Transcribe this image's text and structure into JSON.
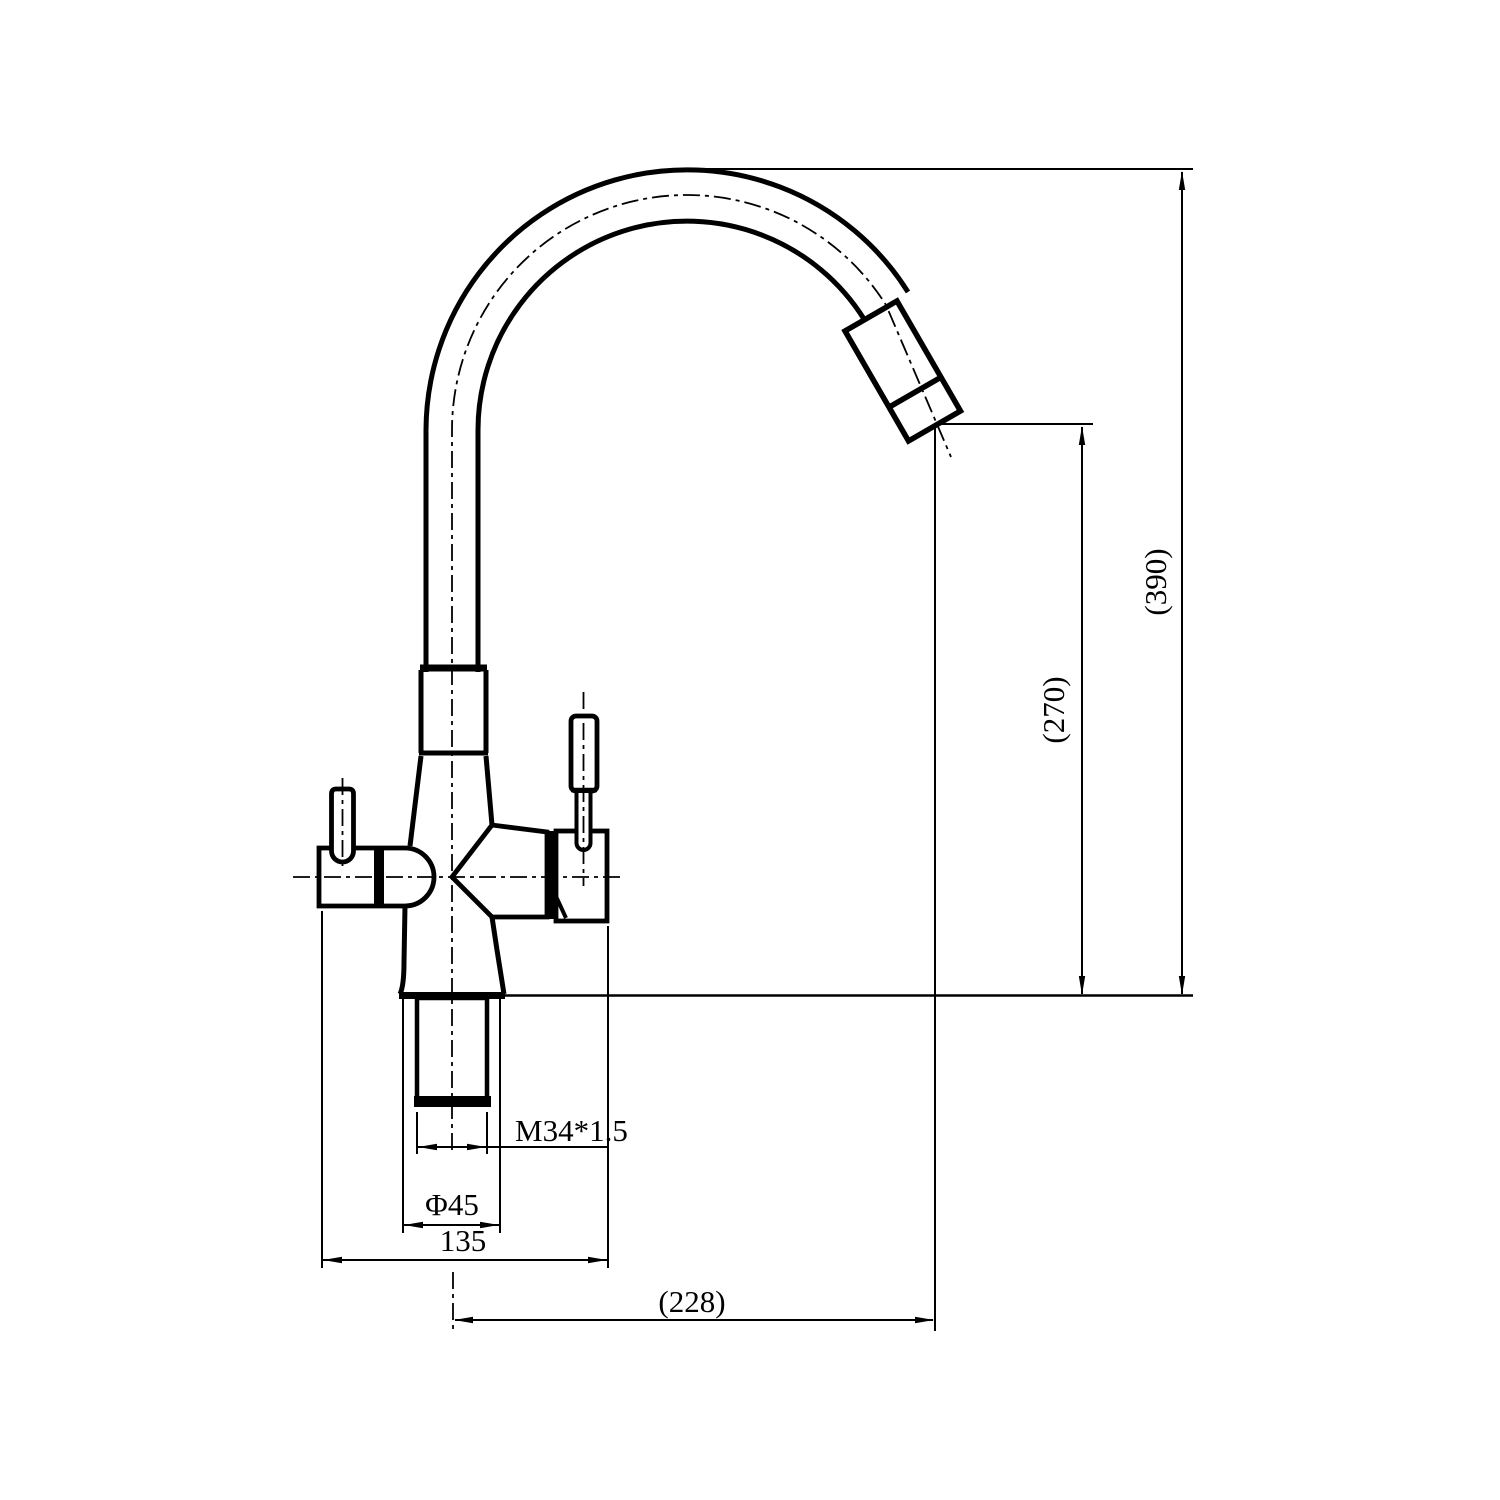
{
  "drawing": {
    "type": "technical-dimension-drawing",
    "subject": "kitchen faucet with gooseneck spout, two lever handles, threaded mounting shank",
    "colors": {
      "line": "#000000",
      "background": "#ffffff"
    },
    "dimensions": {
      "overall_height": "(390)",
      "outlet_height": "(270)",
      "spout_reach": "(228)",
      "body_width": "135",
      "base_diameter": "Φ45",
      "mounting_thread": "M34*1.5"
    }
  }
}
